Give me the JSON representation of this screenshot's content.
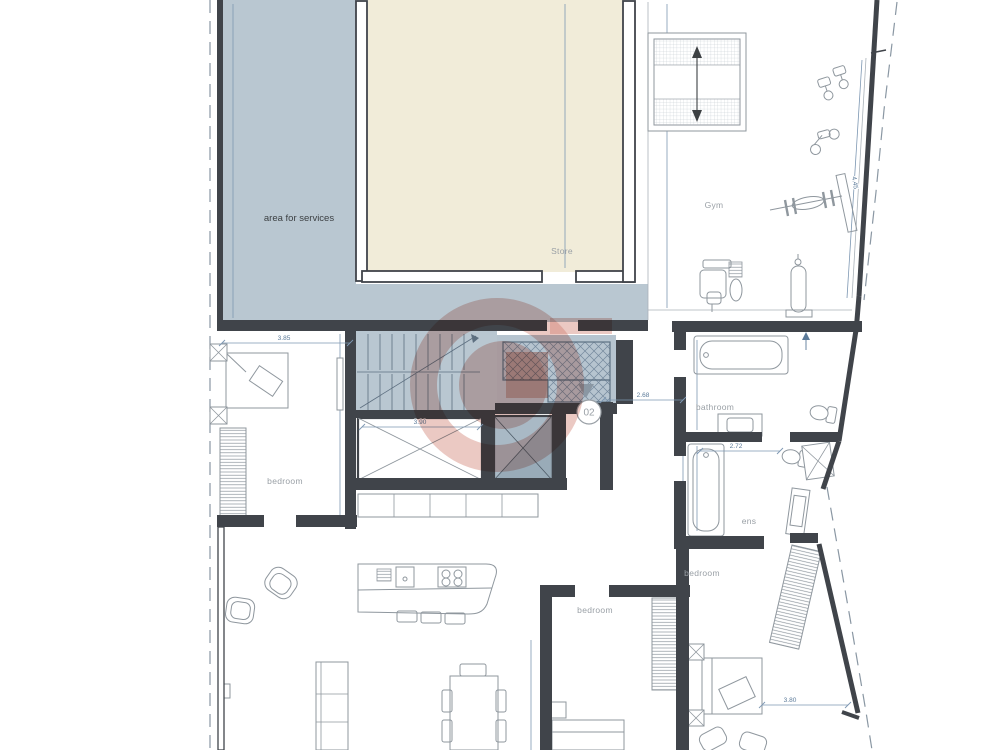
{
  "plan": {
    "rooms": {
      "services": "area for services",
      "store": "Store",
      "gym": "Gym",
      "bathroom": "bathroom",
      "ensuite": "ens",
      "bedroom_left": "bedroom",
      "bedroom_middle": "bedroom",
      "bedroom_right": "bedroom"
    },
    "unit": {
      "number": "02"
    },
    "dimensions": {
      "bedroom_left_width": "3.85",
      "lift_width": "3.90",
      "hall_width": "2.68",
      "ensuite_width": "2.72",
      "bedroom_right_width": "3.80",
      "gym_wall_length": "4.45"
    },
    "colors": {
      "services_fill": "#b9c7d1",
      "store_fill": "#f1ecd9",
      "hatch_fill": "#b6c4cf",
      "lift_shaft_fill": "#a9b9c5",
      "wall": "#40444a",
      "dimension_line": "#7d97b2",
      "room_label": "#9aa0a6",
      "watermark": "#cf7f6f"
    }
  }
}
